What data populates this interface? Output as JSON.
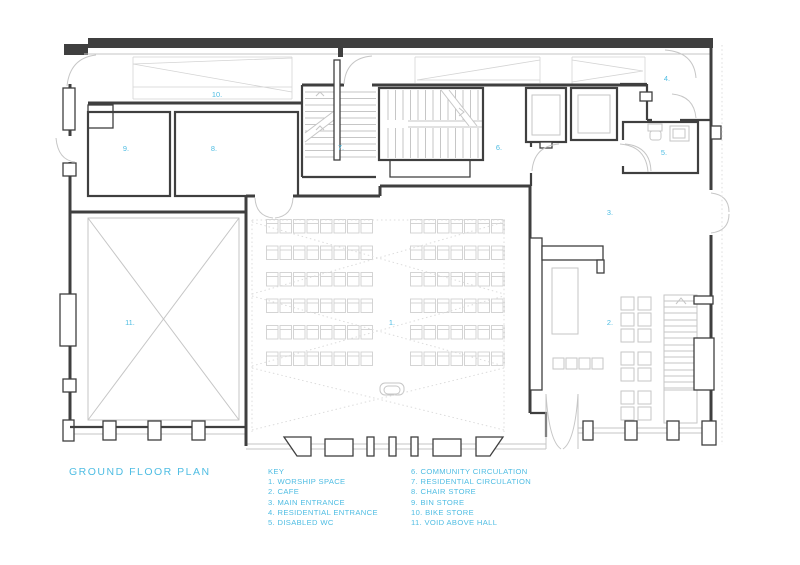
{
  "title": "GROUND FLOOR PLAN",
  "key": {
    "heading": "KEY",
    "left": [
      "1. WORSHIP SPACE",
      "2. CAFE",
      "3. MAIN ENTRANCE",
      "4. RESIDENTIAL ENTRANCE",
      "5. DISABLED WC"
    ],
    "right": [
      "6. COMMUNITY CIRCULATION",
      "7. RESIDENTIAL CIRCULATION",
      "8. CHAIR STORE",
      "9. BIN STORE",
      "10. BIKE STORE",
      "11. VOID ABOVE HALL"
    ]
  },
  "rooms": [
    {
      "number": "1.",
      "name": "worship space"
    },
    {
      "number": "2.",
      "name": "cafe"
    },
    {
      "number": "3.",
      "name": "main entrance"
    },
    {
      "number": "4.",
      "name": "residential entrance"
    },
    {
      "number": "5.",
      "name": "disabled wc"
    },
    {
      "number": "6.",
      "name": "community circulation"
    },
    {
      "number": "7.",
      "name": "residential circulation"
    },
    {
      "number": "8.",
      "name": "chair store"
    },
    {
      "number": "9.",
      "name": "bin store"
    },
    {
      "number": "10.",
      "name": "bike store"
    },
    {
      "number": "11.",
      "name": "void above hall"
    }
  ],
  "colors": {
    "accent": "#4fbde3",
    "walls": "#3f3f3f",
    "light_detail": "#c6c6c6"
  }
}
